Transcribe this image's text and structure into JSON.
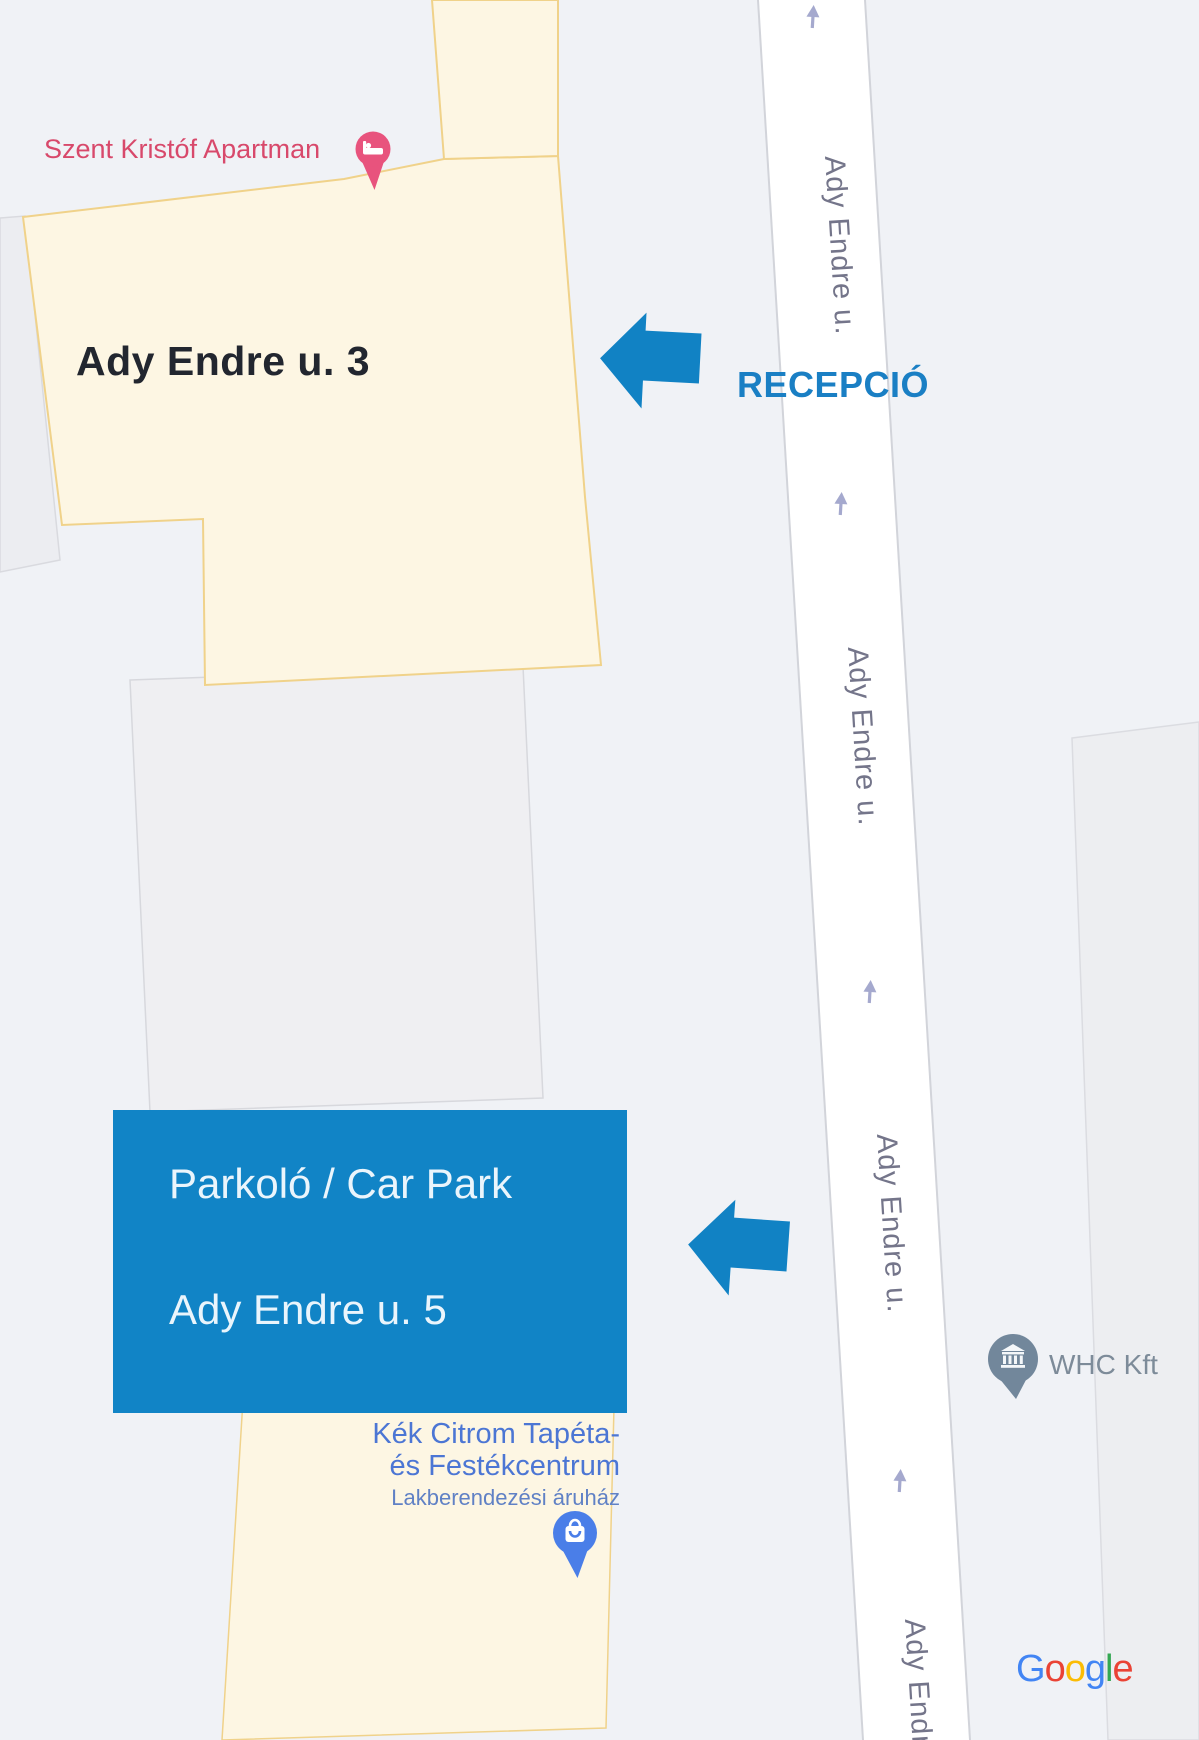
{
  "map": {
    "type": "google-map-annotated-directions",
    "background": "#F0F2F6",
    "attribution_letters": [
      "G",
      "o",
      "o",
      "g",
      "l",
      "e"
    ],
    "attribution_colors": [
      "#4285F4",
      "#EA4335",
      "#FBBC05",
      "#4285F4",
      "#34A853",
      "#EA4335"
    ]
  },
  "places": {
    "apartment": {
      "label": "Szent Kristóf Apartman",
      "color": "#D8496B",
      "icon": "bed-pin",
      "pin_color": "#E8537D"
    },
    "building_3": {
      "label": "Ady Endre u. 3",
      "color": "#22262F",
      "building_fill": "#FDF6E3",
      "building_stroke": "#F0D28A"
    },
    "shop": {
      "line1": "Kék Citrom Tapéta-",
      "line2": "és Festékcentrum",
      "line3": "Lakberendezési áruház",
      "color": "#4C76D4",
      "sub_color": "#6081C5",
      "icon": "shopping-pin",
      "pin_color": "#4A7EE8"
    },
    "company": {
      "label": "WHC Kft",
      "color": "#7D8B99",
      "icon": "bank-pin",
      "pin_color": "#72879B"
    }
  },
  "annotations": {
    "reception": {
      "label": "RECEPCIÓ",
      "color": "#1A7FC4",
      "icon": "left-arrow",
      "arrow_color": "#1182C4"
    },
    "carpark": {
      "line1": "Parkoló / Car Park",
      "line2": "Ady Endre u. 5",
      "box_color": "#1184C6",
      "text_color": "#EAF5FC",
      "icon": "left-arrow",
      "arrow_color": "#1182C4"
    }
  },
  "road": {
    "name": "Ady Endre u.",
    "label_instances": 4,
    "label_color": "#74758A",
    "oneway_icon": "up-arrow",
    "oneway_arrow_count": 4,
    "oneway_color": "#A5A9CE",
    "road_fill": "#FFFFFF",
    "road_edge": "#D2D4DA"
  }
}
